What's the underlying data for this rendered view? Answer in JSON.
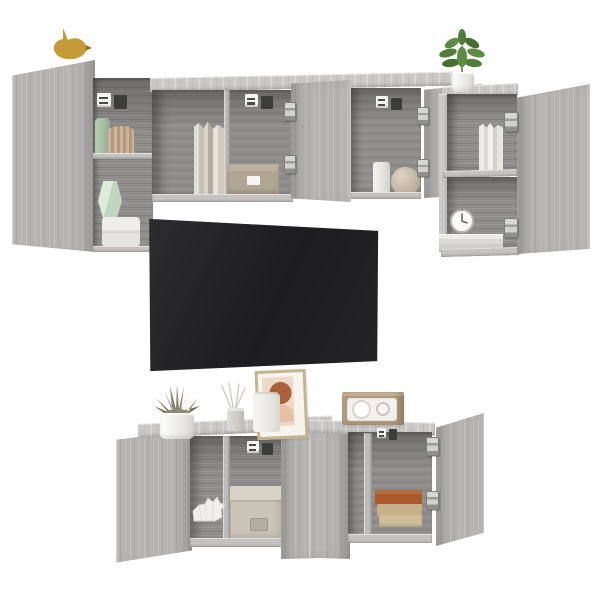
{
  "scene": {
    "type": "product photo",
    "subject": "6-piece wall-mounted TV wall unit in grey sonoma wood look with open doors, TV and styling decor",
    "background_color": "#ffffff"
  },
  "furniture": {
    "finish_label": "grey sonoma wood grain",
    "wood_face_color": "#b5b4b2",
    "wood_top_color": "#c9c8c6",
    "interior_color": "#8f8e8c",
    "hardware": {
      "hinge_label": "concealed cabinet hinge",
      "hinge_color": "#c9c9c7",
      "bracket_label": "wall-mount bracket",
      "bracket_plate_color": "#f2f2f0",
      "bracket_block_color": "#3c3c3a"
    },
    "parts": {
      "upper_left_door": "open wall-cabinet door",
      "upper_left_shelf": "open wall shelf box",
      "upper_mid_cabinet": "wall cabinet with open door",
      "upper_right_cabinet": "tall wall cabinet with open doors",
      "lower_left_cabinet": "TV cabinet with open left door",
      "lower_right_cabinet": "TV cabinet with open right door"
    }
  },
  "tv": {
    "label": "wall-mounted flat screen TV",
    "screen_color": "#212123"
  },
  "decor": {
    "bird": {
      "label": "gold bird figurine",
      "color": "#c59a38"
    },
    "plant": {
      "label": "green plant in white pot",
      "color": "#527c3b"
    },
    "green_vase": {
      "label": "sage green vase",
      "color": "#a9bfa4"
    },
    "paper_fan": {
      "label": "pleated paper fan",
      "color": "#c2a98f"
    },
    "mint_vase": {
      "label": "mint geometric vase",
      "color": "#d6e6d3"
    },
    "bowl_stack": {
      "label": "stacked white bowls",
      "color": "#eae8e4"
    },
    "books_upper": {
      "label": "row of books",
      "color": "#d5cfc3"
    },
    "drawer_box": {
      "label": "small storage box with label",
      "color": "#b1a694"
    },
    "cylinder_vase": {
      "label": "white cylinder vase",
      "color": "#eceae6"
    },
    "sphere_vase": {
      "label": "round beige vase",
      "color": "#c9bda9"
    },
    "white_books": {
      "label": "white books",
      "color": "#e9e7e2"
    },
    "alarm_clock": {
      "label": "white alarm clock",
      "color": "#fbfaf8"
    },
    "book_pile": {
      "label": "pile of white books",
      "color": "#e5e3de"
    },
    "succulent": {
      "label": "succulent in white pot",
      "color": "#857d68"
    },
    "diffuser": {
      "label": "reed diffuser",
      "color": "#d5d1ca"
    },
    "canister": {
      "label": "white canister",
      "color": "#efede9"
    },
    "frame": {
      "label": "framed abstract art",
      "color": "#ecd9c8"
    },
    "rhino": {
      "label": "white origami rhino figurine",
      "color": "#f1efec"
    },
    "fabric_box": {
      "label": "beige fabric storage box",
      "color": "#cbc4b8"
    },
    "radio": {
      "label": "retro wooden radio",
      "color": "#b29a7c"
    },
    "books_lower": {
      "label": "stacked hardcover books",
      "color": "#a85a2e"
    }
  }
}
